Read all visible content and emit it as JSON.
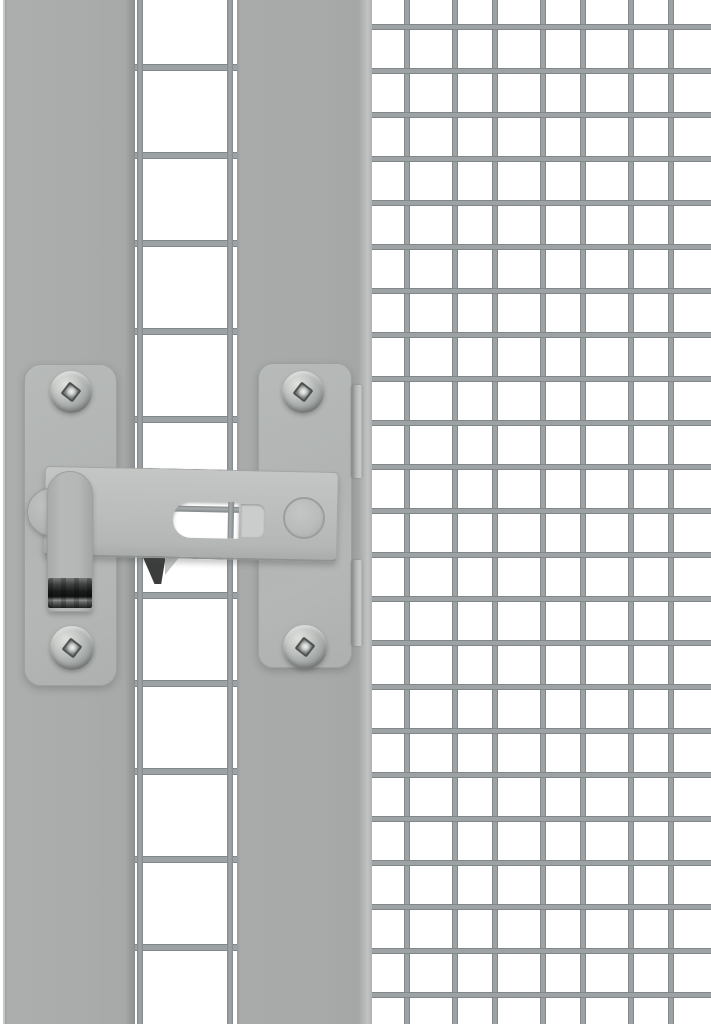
{
  "scene": {
    "type": "product-photo",
    "subject": "Grey metal gate latch mounted between a frame post and welded wire mesh panels",
    "elements": {
      "left_frame_post": "vertical grey frame post at left edge",
      "left_mesh_panel": "coarse welded-mesh strip (two vertical wires, ~88px pitch)",
      "center_frame_post": "wide grey frame post behind the latch catch plate",
      "right_mesh_panel": "fine welded-mesh panel (~44px pitch)",
      "latch": {
        "left_mounting_plate": "rounded mounting plate with two pan-head screws",
        "right_mounting_plate": "rounded catch plate with two pan-head screws and two folded edge tabs",
        "latch_bar": "horizontal sliding latch bar with elongated slot",
        "slot": "elongated cut-out in latch bar showing mesh wires behind",
        "pivot": "round pivot rivet at left end of bar",
        "handle_strap": "vertical flip handle with dark serrated finger grip",
        "end_pin": "round rivet pin at right end of bar",
        "screws": "four pan-head screws with square drive recess"
      }
    }
  },
  "palette": {
    "background": "#ffffff",
    "post": "#a9abab",
    "post_edge": "#8f9392",
    "wire": "#9da2a4",
    "wire_dark": "#82888a",
    "plate": "#b3b6b5",
    "plate_edge": "#9da19f",
    "bar": "#bcbebd",
    "screw_light": "#dfe1de",
    "screw_dark": "#8b8f8e",
    "grip_dark": "#1a1b1b",
    "shadow_wedge": "#3b3d3c"
  }
}
